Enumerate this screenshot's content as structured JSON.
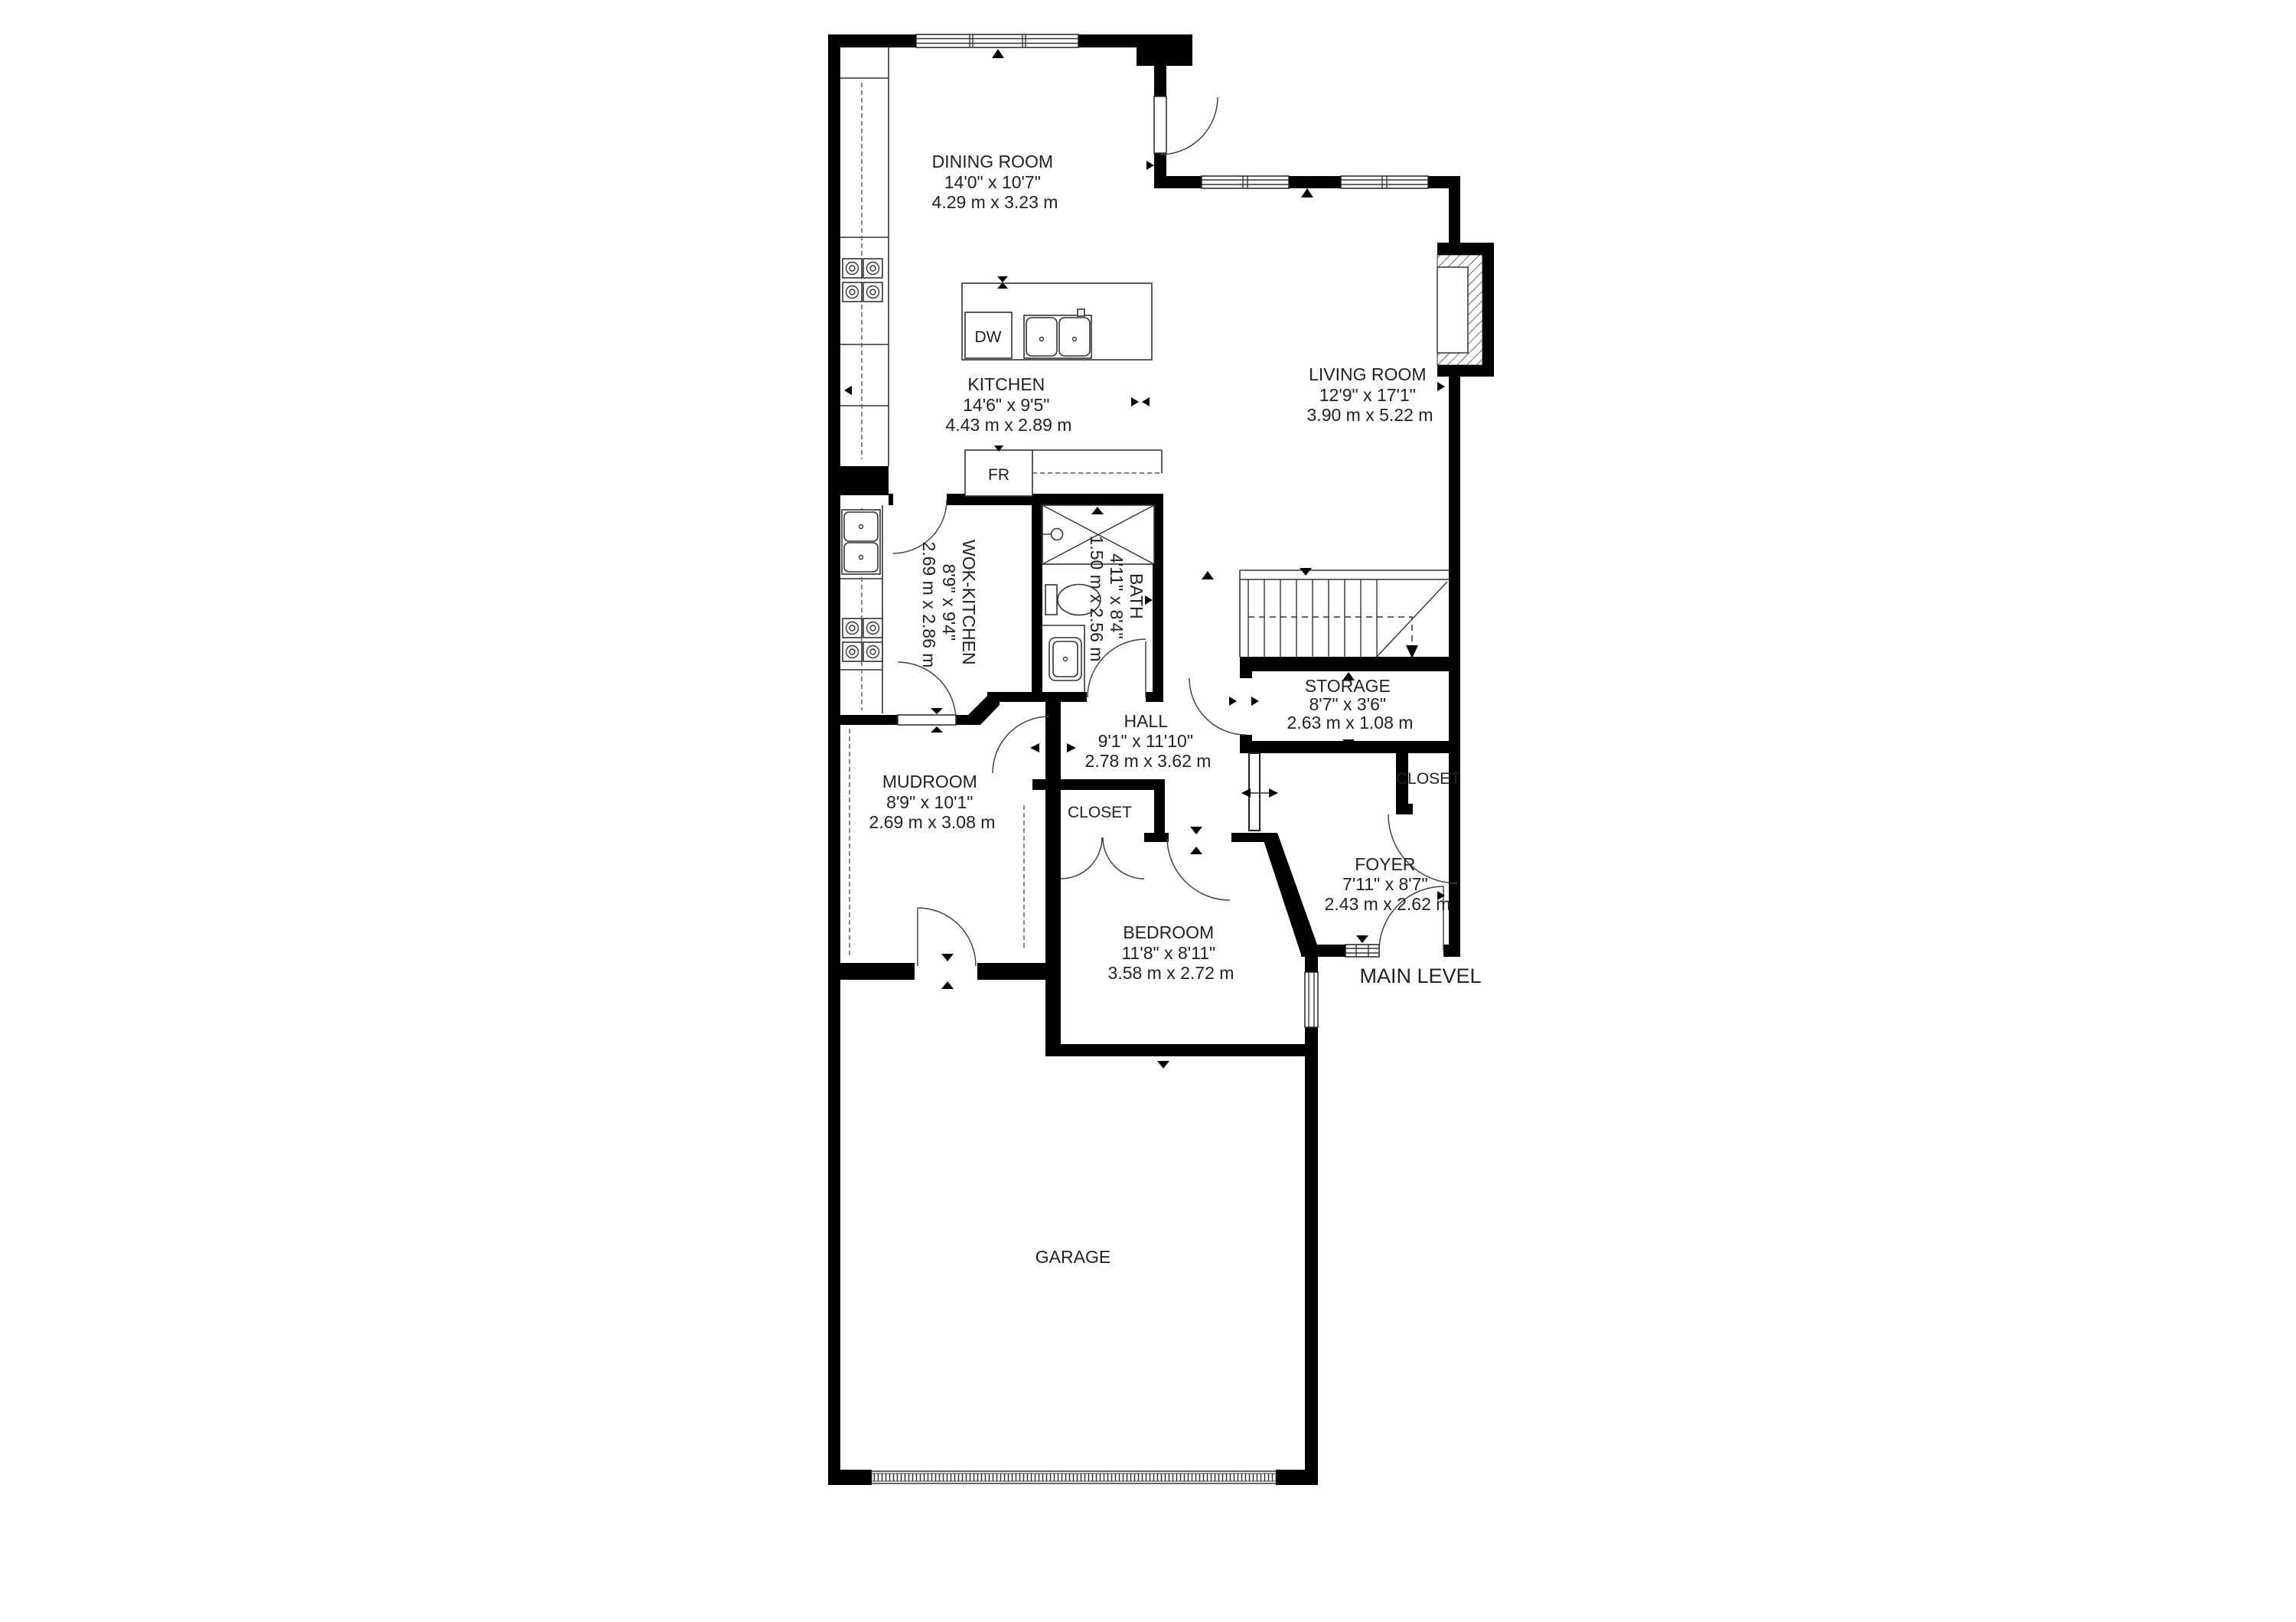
{
  "colors": {
    "wall": "#000000",
    "text": "#222222",
    "line": "#333333"
  },
  "floor_plan": {
    "level_label": "MAIN LEVEL",
    "rooms": [
      {
        "id": "dining-room",
        "name": "DINING ROOM",
        "imperial": "14'0\" x 10'7\"",
        "metric": "4.29 m x 3.23 m"
      },
      {
        "id": "kitchen",
        "name": "KITCHEN",
        "imperial": "14'6\" x 9'5\"",
        "metric": "4.43 m x 2.89 m"
      },
      {
        "id": "living-room",
        "name": "LIVING ROOM",
        "imperial": "12'9\" x 17'1\"",
        "metric": "3.90 m x 5.22 m"
      },
      {
        "id": "wok-kitchen",
        "name": "WOK-KITCHEN",
        "imperial": "8'9\" x 9'4\"",
        "metric": "2.69 m x 2.86 m"
      },
      {
        "id": "bath",
        "name": "BATH",
        "imperial": "4'11\" x 8'4\"",
        "metric": "1.50 m x 2.56 m"
      },
      {
        "id": "hall",
        "name": "HALL",
        "imperial": "9'1\" x 11'10\"",
        "metric": "2.78 m x 3.62 m"
      },
      {
        "id": "storage",
        "name": "STORAGE",
        "imperial": "8'7\" x 3'6\"",
        "metric": "2.63 m x 1.08 m"
      },
      {
        "id": "closet-hall",
        "name": "CLOSET"
      },
      {
        "id": "closet-foyer",
        "name": "CLOSET"
      },
      {
        "id": "mudroom",
        "name": "MUDROOM",
        "imperial": "8'9\" x 10'1\"",
        "metric": "2.69 m x 3.08 m"
      },
      {
        "id": "foyer",
        "name": "FOYER",
        "imperial": "7'11\" x 8'7\"",
        "metric": "2.43 m x 2.62 m"
      },
      {
        "id": "bedroom",
        "name": "BEDROOM",
        "imperial": "11'8\" x 8'11\"",
        "metric": "3.58 m x 2.72 m"
      },
      {
        "id": "garage",
        "name": "GARAGE"
      }
    ],
    "appliances": {
      "dishwasher": "DW",
      "fridge": "FR"
    }
  }
}
